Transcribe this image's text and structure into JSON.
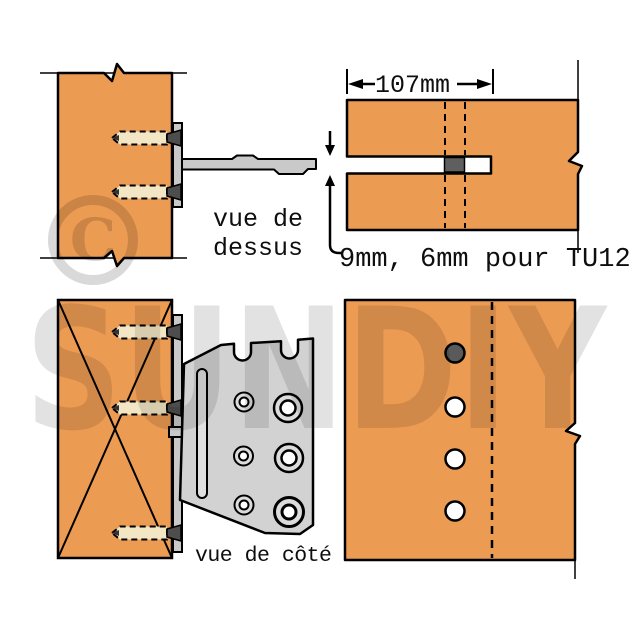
{
  "watermark": {
    "brand": "SUNDIY",
    "copyright_letter": "C"
  },
  "labels": {
    "top_view": {
      "line1": "vue de",
      "line2": "dessus"
    },
    "side_view": "vue de côté",
    "dimension_width": "107mm",
    "dimension_note": "9mm, 6mm pour TU12"
  },
  "colors": {
    "wood": "#EC9B52",
    "metal_arm": "#C9C9C9",
    "metal_plate": "#D2D2D2",
    "screw_body": "#F3E6C4",
    "screw_head": "#4D4D4D",
    "slot_insert": "#5F5F5F",
    "outline": "#000000",
    "watermark_gray": "#E2E2E2"
  }
}
